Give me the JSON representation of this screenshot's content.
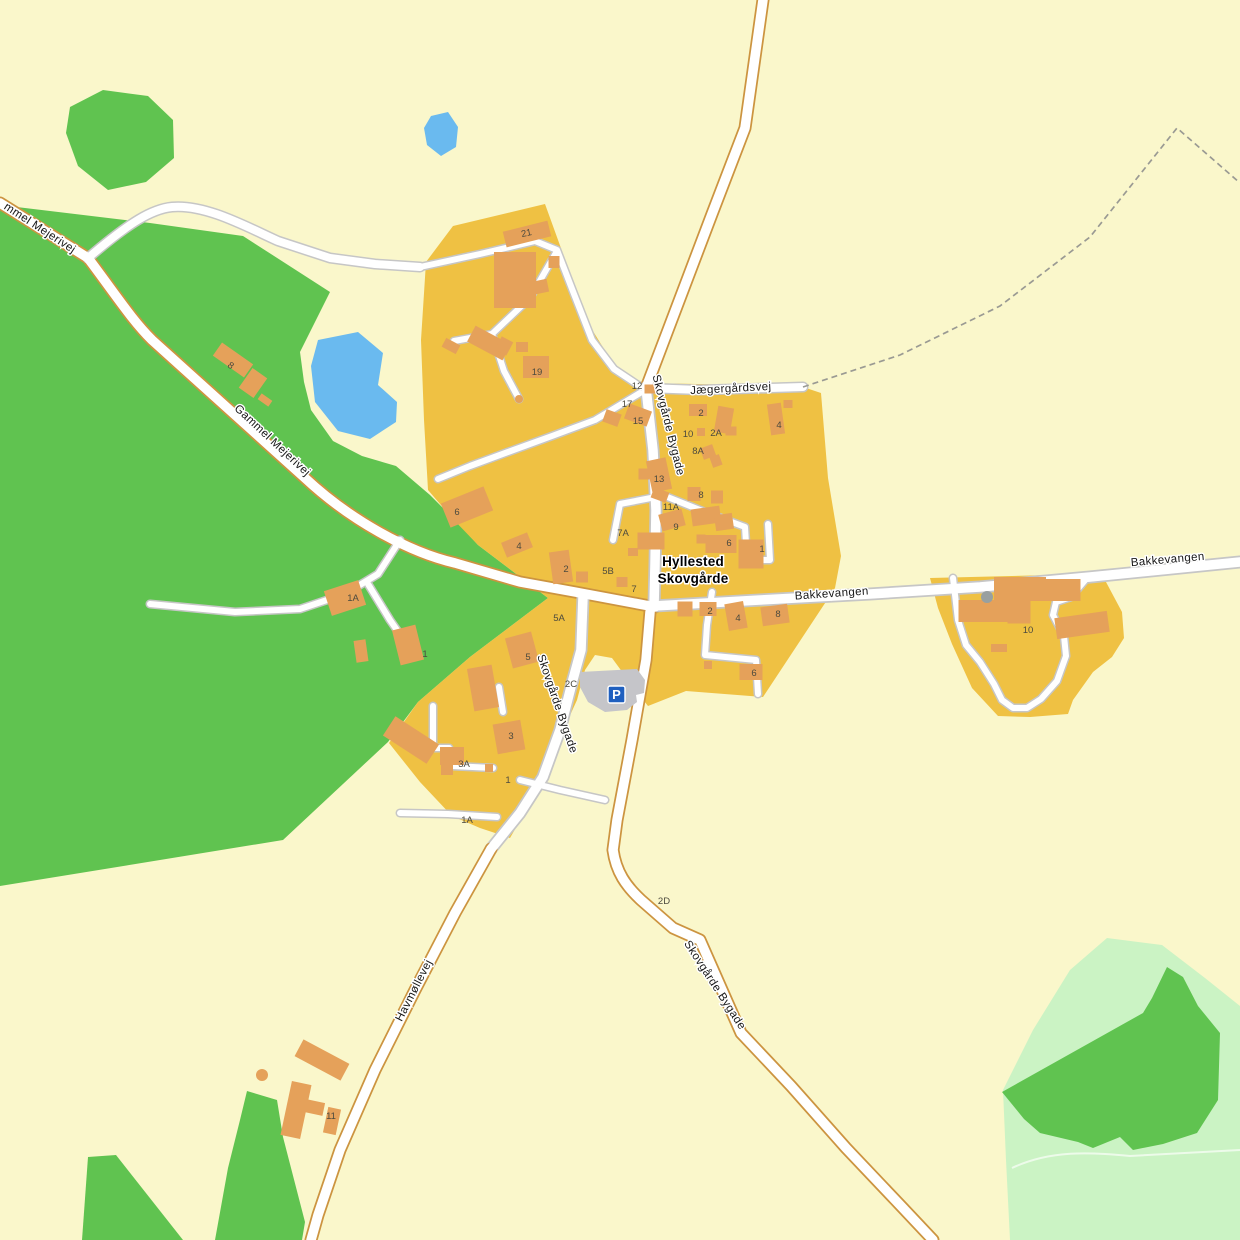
{
  "map": {
    "colors": {
      "bg": "#FAF7CB",
      "village": "#EFC143",
      "building": "#E5A15A",
      "forestDark": "#60C350",
      "forestLight": "#CBF3C4",
      "water": "#6ABAEF",
      "road": "#FFFFFF",
      "casingMinor": "#C6C6C6",
      "casingMajor": "#CC9440",
      "dash": "#9A9A93",
      "parkingGray": "#C5C5C9",
      "pBlue": "#1F5FBF",
      "silo": "#98A0A0"
    },
    "town_label": {
      "line1": "Hyllested",
      "line2": "Skovgårde",
      "x": 693,
      "y": 566,
      "line_height": 17
    },
    "street_labels": [
      {
        "text": "mmel Mejerivej",
        "x": 38,
        "y": 231,
        "rot": 33
      },
      {
        "text": "Gammel Mejerivej",
        "x": 270,
        "y": 443,
        "rot": 43
      },
      {
        "text": "Skovgårde Bygade",
        "x": 665,
        "y": 426,
        "rot": 76
      },
      {
        "text": "Jægergårdsvej",
        "x": 731,
        "y": 392,
        "rot": -3
      },
      {
        "text": "Bakkevangen",
        "x": 832,
        "y": 597,
        "rot": -4
      },
      {
        "text": "Bakkevangen",
        "x": 1168,
        "y": 563,
        "rot": -5
      },
      {
        "text": "Skovgårde Bygade",
        "x": 554,
        "y": 705,
        "rot": 71
      },
      {
        "text": "Skovgårde Bygade",
        "x": 712,
        "y": 987,
        "rot": 57
      },
      {
        "text": "Havmøllevej",
        "x": 417,
        "y": 992,
        "rot": -63
      }
    ],
    "house_numbers": [
      {
        "text": "21",
        "x": 527,
        "y": 236,
        "rot": -12
      },
      {
        "text": "19",
        "x": 537,
        "y": 375
      },
      {
        "text": "8",
        "x": 229,
        "y": 368,
        "rot": 35
      },
      {
        "text": "12",
        "x": 637,
        "y": 389
      },
      {
        "text": "17",
        "x": 627,
        "y": 407
      },
      {
        "text": "15",
        "x": 638,
        "y": 424
      },
      {
        "text": "13",
        "x": 659,
        "y": 482
      },
      {
        "text": "11A",
        "x": 671,
        "y": 510
      },
      {
        "text": "9",
        "x": 676,
        "y": 530
      },
      {
        "text": "7A",
        "x": 623,
        "y": 536
      },
      {
        "text": "6",
        "x": 457,
        "y": 515
      },
      {
        "text": "4",
        "x": 519,
        "y": 549
      },
      {
        "text": "2",
        "x": 566,
        "y": 572
      },
      {
        "text": "5B",
        "x": 608,
        "y": 574
      },
      {
        "text": "7",
        "x": 634,
        "y": 592
      },
      {
        "text": "2",
        "x": 701,
        "y": 416
      },
      {
        "text": "10",
        "x": 688,
        "y": 437
      },
      {
        "text": "2A",
        "x": 716,
        "y": 436
      },
      {
        "text": "8A",
        "x": 698,
        "y": 454
      },
      {
        "text": "4",
        "x": 779,
        "y": 428
      },
      {
        "text": "8",
        "x": 701,
        "y": 498
      },
      {
        "text": "6",
        "x": 729,
        "y": 546
      },
      {
        "text": "1",
        "x": 762,
        "y": 552
      },
      {
        "text": "2",
        "x": 710,
        "y": 614
      },
      {
        "text": "4",
        "x": 738,
        "y": 621
      },
      {
        "text": "8",
        "x": 778,
        "y": 617
      },
      {
        "text": "6",
        "x": 754,
        "y": 676
      },
      {
        "text": "10",
        "x": 1028,
        "y": 633
      },
      {
        "text": "5A",
        "x": 559,
        "y": 621
      },
      {
        "text": "5",
        "x": 528,
        "y": 660
      },
      {
        "text": "2C",
        "x": 571,
        "y": 687
      },
      {
        "text": "3",
        "x": 511,
        "y": 739
      },
      {
        "text": "3A",
        "x": 464,
        "y": 767
      },
      {
        "text": "1",
        "x": 508,
        "y": 783
      },
      {
        "text": "1A",
        "x": 467,
        "y": 823
      },
      {
        "text": "1A",
        "x": 353,
        "y": 601
      },
      {
        "text": "1",
        "x": 425,
        "y": 657
      },
      {
        "text": "11",
        "x": 331,
        "y": 1119
      },
      {
        "text": "2D",
        "x": 664,
        "y": 904
      }
    ],
    "buildings": [
      [
        527,
        234,
        46,
        16,
        -14
      ],
      [
        515,
        280,
        42,
        56,
        0
      ],
      [
        539,
        287,
        18,
        13,
        -12
      ],
      [
        554,
        262,
        11,
        12,
        0
      ],
      [
        489,
        343,
        40,
        18,
        28
      ],
      [
        504,
        346,
        13,
        15,
        28
      ],
      [
        522,
        347,
        12,
        10,
        0
      ],
      [
        536,
        367,
        26,
        22,
        0
      ],
      [
        451,
        346,
        16,
        10,
        28
      ],
      [
        233,
        360,
        38,
        16,
        35
      ],
      [
        253,
        383,
        18,
        24,
        35
      ],
      [
        265,
        400,
        13,
        7,
        35
      ],
      [
        345,
        598,
        36,
        26,
        -18
      ],
      [
        361,
        651,
        12,
        22,
        -8
      ],
      [
        408,
        645,
        24,
        36,
        -14
      ],
      [
        467,
        507,
        46,
        26,
        -22
      ],
      [
        517,
        545,
        28,
        16,
        -22
      ],
      [
        561,
        567,
        20,
        32,
        -8
      ],
      [
        582,
        577,
        12,
        11,
        0
      ],
      [
        622,
        582,
        11,
        10,
        0
      ],
      [
        651,
        541,
        27,
        17,
        0
      ],
      [
        633,
        552,
        10,
        8,
        0
      ],
      [
        612,
        418,
        16,
        13,
        20
      ],
      [
        638,
        415,
        24,
        16,
        20
      ],
      [
        650,
        389,
        11,
        9,
        0
      ],
      [
        659,
        475,
        20,
        32,
        -12
      ],
      [
        644,
        474,
        11,
        11,
        0
      ],
      [
        660,
        495,
        16,
        11,
        20
      ],
      [
        672,
        520,
        24,
        17,
        -15
      ],
      [
        698,
        410,
        18,
        12,
        0
      ],
      [
        724,
        420,
        16,
        26,
        10
      ],
      [
        701,
        432,
        8,
        8,
        0
      ],
      [
        731,
        431,
        11,
        9,
        0
      ],
      [
        708,
        452,
        13,
        12,
        -20
      ],
      [
        716,
        461,
        10,
        11,
        -20
      ],
      [
        776,
        419,
        14,
        31,
        -8
      ],
      [
        788,
        404,
        9,
        8,
        0
      ],
      [
        694,
        494,
        13,
        14,
        0
      ],
      [
        717,
        497,
        12,
        13,
        0
      ],
      [
        706,
        516,
        29,
        17,
        -8
      ],
      [
        724,
        522,
        18,
        16,
        -8
      ],
      [
        721,
        544,
        31,
        18,
        0
      ],
      [
        701,
        539,
        9,
        9,
        0
      ],
      [
        751,
        554,
        25,
        29,
        0
      ],
      [
        685,
        609,
        15,
        15,
        0
      ],
      [
        708,
        609,
        17,
        14,
        0
      ],
      [
        736,
        616,
        19,
        27,
        -10
      ],
      [
        775,
        615,
        27,
        19,
        -8
      ],
      [
        751,
        672,
        23,
        16,
        0
      ],
      [
        708,
        665,
        8,
        8,
        0
      ],
      [
        1020,
        589,
        52,
        24,
        0
      ],
      [
        983,
        611,
        49,
        22,
        0
      ],
      [
        1019,
        610,
        23,
        27,
        0
      ],
      [
        1063,
        590,
        35,
        22,
        0
      ],
      [
        1082,
        625,
        53,
        21,
        -8
      ],
      [
        999,
        648,
        16,
        8,
        0
      ],
      [
        522,
        650,
        27,
        31,
        -15
      ],
      [
        483,
        688,
        25,
        43,
        -10
      ],
      [
        509,
        737,
        28,
        30,
        -10
      ],
      [
        452,
        756,
        24,
        18,
        0
      ],
      [
        447,
        769,
        12,
        12,
        0
      ],
      [
        489,
        768,
        8,
        8,
        0
      ],
      [
        411,
        740,
        52,
        23,
        33
      ],
      [
        322,
        1060,
        52,
        19,
        28
      ],
      [
        296,
        1110,
        20,
        55,
        12
      ],
      [
        312,
        1107,
        24,
        13,
        12
      ],
      [
        332,
        1121,
        13,
        26,
        12
      ]
    ],
    "circles": [
      [
        519,
        399,
        4,
        "building"
      ],
      [
        987,
        597,
        6,
        "silo"
      ],
      [
        262,
        1075,
        6,
        "building"
      ]
    ],
    "parking": {
      "letter": "P"
    }
  }
}
